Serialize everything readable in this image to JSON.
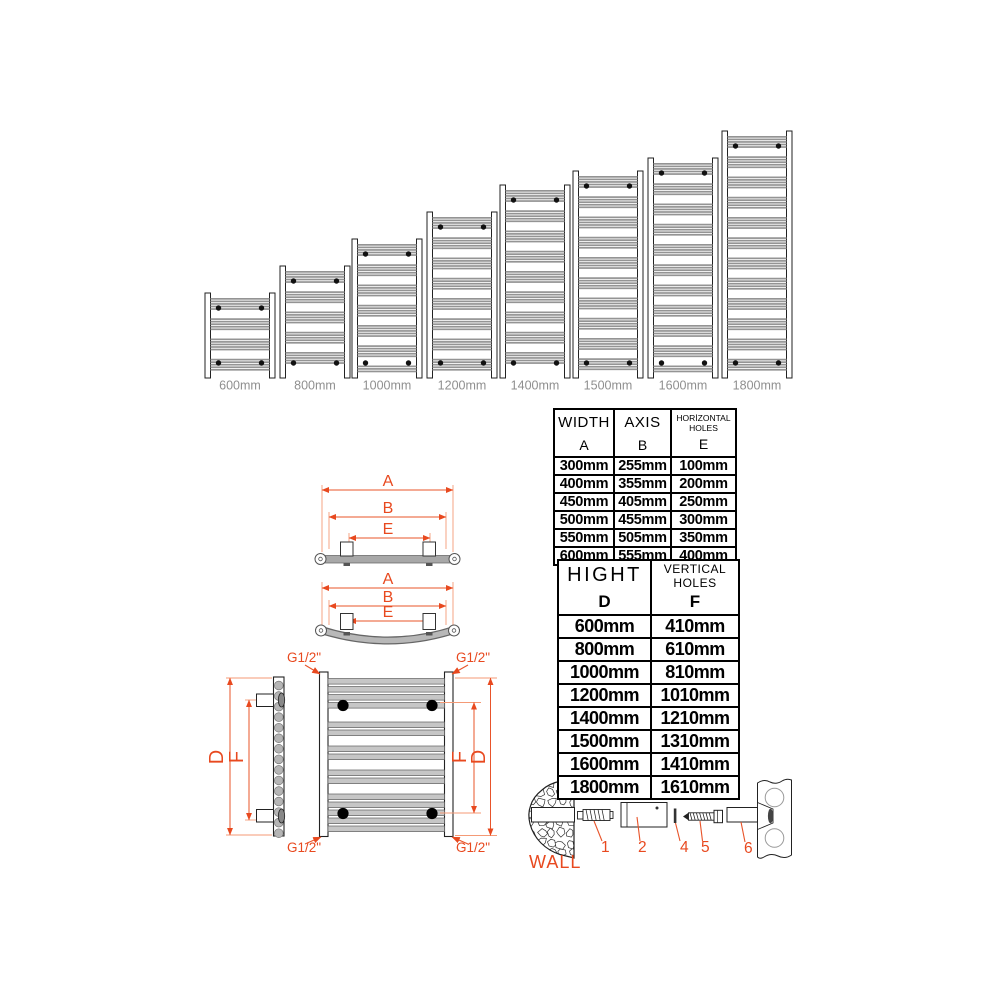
{
  "accent_color": "#e8491f",
  "lineup": {
    "items": [
      {
        "label": "600mm",
        "height_mm": 600
      },
      {
        "label": "800mm",
        "height_mm": 800
      },
      {
        "label": "1000mm",
        "height_mm": 1000
      },
      {
        "label": "1200mm",
        "height_mm": 1200
      },
      {
        "label": "1400mm",
        "height_mm": 1400
      },
      {
        "label": "1500mm",
        "height_mm": 1500
      },
      {
        "label": "1600mm",
        "height_mm": 1600
      },
      {
        "label": "1800mm",
        "height_mm": 1800
      }
    ]
  },
  "dims": {
    "overall_width": "A",
    "axis": "B",
    "horizontal_holes": "E",
    "overall_height": "D",
    "vertical_holes": "F"
  },
  "connection": {
    "label": "G1/2\""
  },
  "width_table": {
    "headers": [
      {
        "title": "WIDTH",
        "letter": "A"
      },
      {
        "title": "AXIS",
        "letter": "B"
      },
      {
        "title": "HORİZONTAL HOLES",
        "letter": "E"
      }
    ],
    "rows": [
      [
        "300mm",
        "255mm",
        "100mm"
      ],
      [
        "400mm",
        "355mm",
        "200mm"
      ],
      [
        "450mm",
        "405mm",
        "250mm"
      ],
      [
        "500mm",
        "455mm",
        "300mm"
      ],
      [
        "550mm",
        "505mm",
        "350mm"
      ],
      [
        "600mm",
        "555mm",
        "400mm"
      ]
    ]
  },
  "height_table": {
    "headers": [
      {
        "title": "HIGHT",
        "letter": "D"
      },
      {
        "title": "VERTICAL HOLES",
        "letter": "F"
      }
    ],
    "rows": [
      [
        "600mm",
        "410mm"
      ],
      [
        "800mm",
        "610mm"
      ],
      [
        "1000mm",
        "810mm"
      ],
      [
        "1200mm",
        "1010mm"
      ],
      [
        "1400mm",
        "1210mm"
      ],
      [
        "1500mm",
        "1310mm"
      ],
      [
        "1600mm",
        "1410mm"
      ],
      [
        "1800mm",
        "1610mm"
      ]
    ]
  },
  "mounting": {
    "wall_label": "WALL",
    "part_numbers": [
      "1",
      "2",
      "3",
      "4",
      "5",
      "6"
    ]
  }
}
